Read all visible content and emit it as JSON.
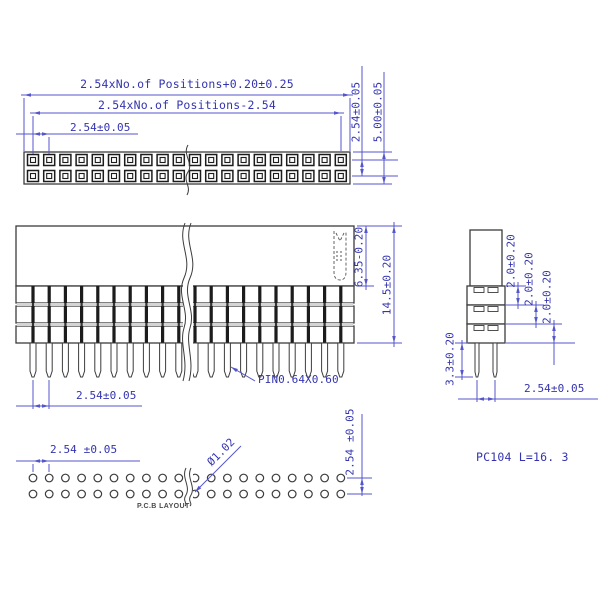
{
  "drawing": {
    "part_note": "PC104 L=16. 3",
    "positions_shown": 20,
    "socket_rows": 2,
    "stack_rows": 3,
    "pcb_hole_rows": 2
  },
  "top_view": {
    "dim_overall_length": "2.54xNo.of Positions+0.20±0.25",
    "dim_pin_span": "2.54xNo.of Positions-2.54",
    "dim_pitch": "2.54±0.05",
    "dim_row_spacing": "2.54±0.05",
    "dim_body_width": "5.00±0.05"
  },
  "front_view": {
    "dim_insulator_height": "6.35-0.20",
    "dim_total_height": "14.5±0.20",
    "dim_pitch": "2.54±0.05",
    "pin_callout": "PIN0.64X0.60"
  },
  "side_view": {
    "dim_row1_height": "2.0±0.20",
    "dim_row2_height": "2.0±0.20",
    "dim_row3_height": "2.0±0.20",
    "dim_pin_length": "3.3±0.20",
    "dim_pin_spacing": "2.54±0.05"
  },
  "pcb_layout": {
    "dim_pitch": "2.54 ±0.05",
    "dim_row_spacing": "2.54 ±0.05",
    "hole_diameter": "Ø1.02",
    "label": "P.C.B LAYOUT"
  },
  "colors": {
    "dimension_line": "#5656cc",
    "dimension_text": "#3434b0",
    "outline": "#3c3c3c",
    "socket": "#1c1c1c"
  }
}
